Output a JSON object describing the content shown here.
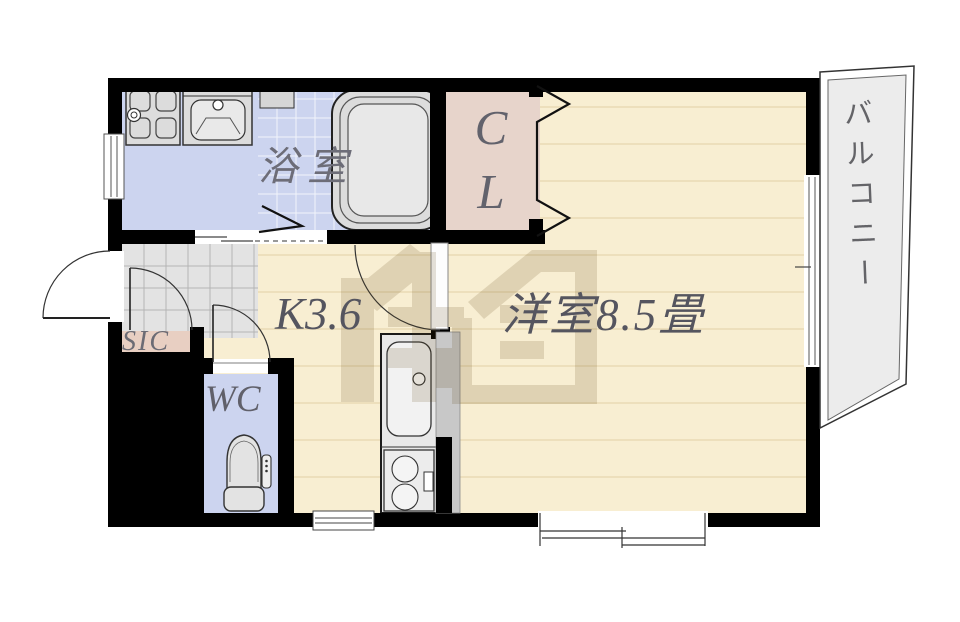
{
  "plan": {
    "title": "1K apartment floor plan",
    "rooms": {
      "bathroom": {
        "label": "浴室"
      },
      "closet": {
        "letter_top": "C",
        "letter_bottom": "L"
      },
      "western_room": {
        "label": "洋室8.5畳"
      },
      "kitchen": {
        "label": "K3.6"
      },
      "toilet_room": {
        "label": "WC"
      },
      "shoe_closet": {
        "label": "SIC"
      },
      "balcony": {
        "label": "バルコニー"
      }
    },
    "colors": {
      "wall": "#000000",
      "wet_area_floor": "#ccd4ef",
      "wood_floor": "#f8eed2",
      "wood_floor_line": "#e9dab4",
      "closet_floor": "#e7d4cb",
      "shoe_closet_floor": "#e8cfc2",
      "entrance_tile": "#e3e3e3",
      "balcony_floor": "#ececec",
      "fixture_fill": "#dcdcdc",
      "label_text": "#5c5c66",
      "watermark": "rgba(94,66,16,0.16)"
    }
  }
}
